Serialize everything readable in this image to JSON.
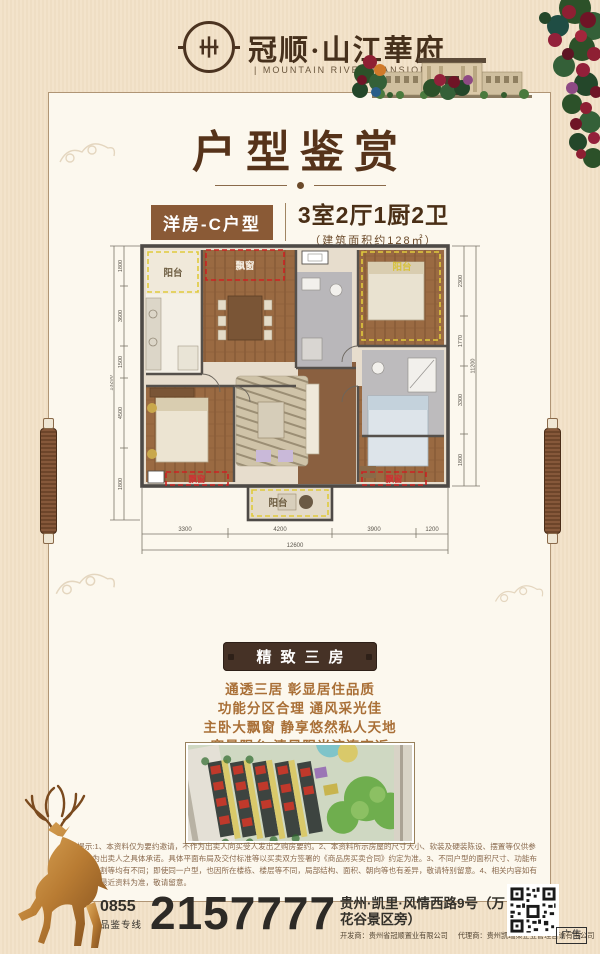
{
  "header": {
    "brand": "冠顺·山江華府",
    "brand_sub": "| MOUNTAIN RIVER MANSION |"
  },
  "title": {
    "main": "户型鉴赏",
    "tag": "洋房-C户型",
    "rooms": "3室2厅1厨2卫",
    "area": "（建筑面积约128㎡）"
  },
  "floorplan": {
    "labels": {
      "balcony": "阳台",
      "bay": "飘窗"
    },
    "dims_bottom": [
      "3300",
      "4200",
      "3900",
      "1200"
    ],
    "dims_bottom_total": "12600",
    "dims_left": [
      "1800",
      "3600",
      "1500",
      "4500",
      "1800"
    ],
    "dims_left_total": "13200",
    "dims_right": [
      "2300",
      "1770",
      "3300",
      "1800"
    ],
    "dims_right_total": "11200"
  },
  "highlight": {
    "badge": "精致三房",
    "features": [
      "通透三居 彰显居住品质",
      "功能分区合理 通风采光佳",
      "主卧大飘窗 静享悠然私人天地",
      "宽景阳台 清风阳光流连忘返"
    ]
  },
  "disclaimer": {
    "text": "温馨提示:1、本资料仅为要约邀请，不作为出卖人向买受人发出之购房要约。2、本资料所示房屋的尺寸大小、软装及硬装陈设、摆置等仅供参阅，不作为出卖人之具体承诺。具体平面布局及交付标准等以买卖双方签署的《商品房买卖合同》约定为准。3、不同户型的面积尺寸、功能布局、空间分割等均有不同；即使同一户型，也因所在楼栋、楼层等不同，局部结构、面积、朝向等也有差异，敬请特别留意。4、相关内容如有更新，请以最近资料为准，敬请留意。"
  },
  "footer": {
    "phone_area": "0855",
    "phone_label": "品鉴专线",
    "phone": "2157777",
    "address": "贵州·凯里·风情西路9号（万花谷景区旁）",
    "developer": "开发商：贵州省冠顺置业有限公司",
    "agent": "代理商：贵州凯瑞策企业管理咨询有限公司"
  },
  "meta": {
    "ad_label": "广告"
  },
  "colors": {
    "background": "#f2e1c8",
    "panel": "#fcf8ee",
    "title_brown": "#56331a",
    "tag_brown": "#8a5a36",
    "badge_brown": "#463226",
    "feature_gold": "#a96f36",
    "wall_gray": "#4e4a46",
    "bay_red": "#cc2222",
    "balcony_yellow": "#e0ca3c"
  }
}
